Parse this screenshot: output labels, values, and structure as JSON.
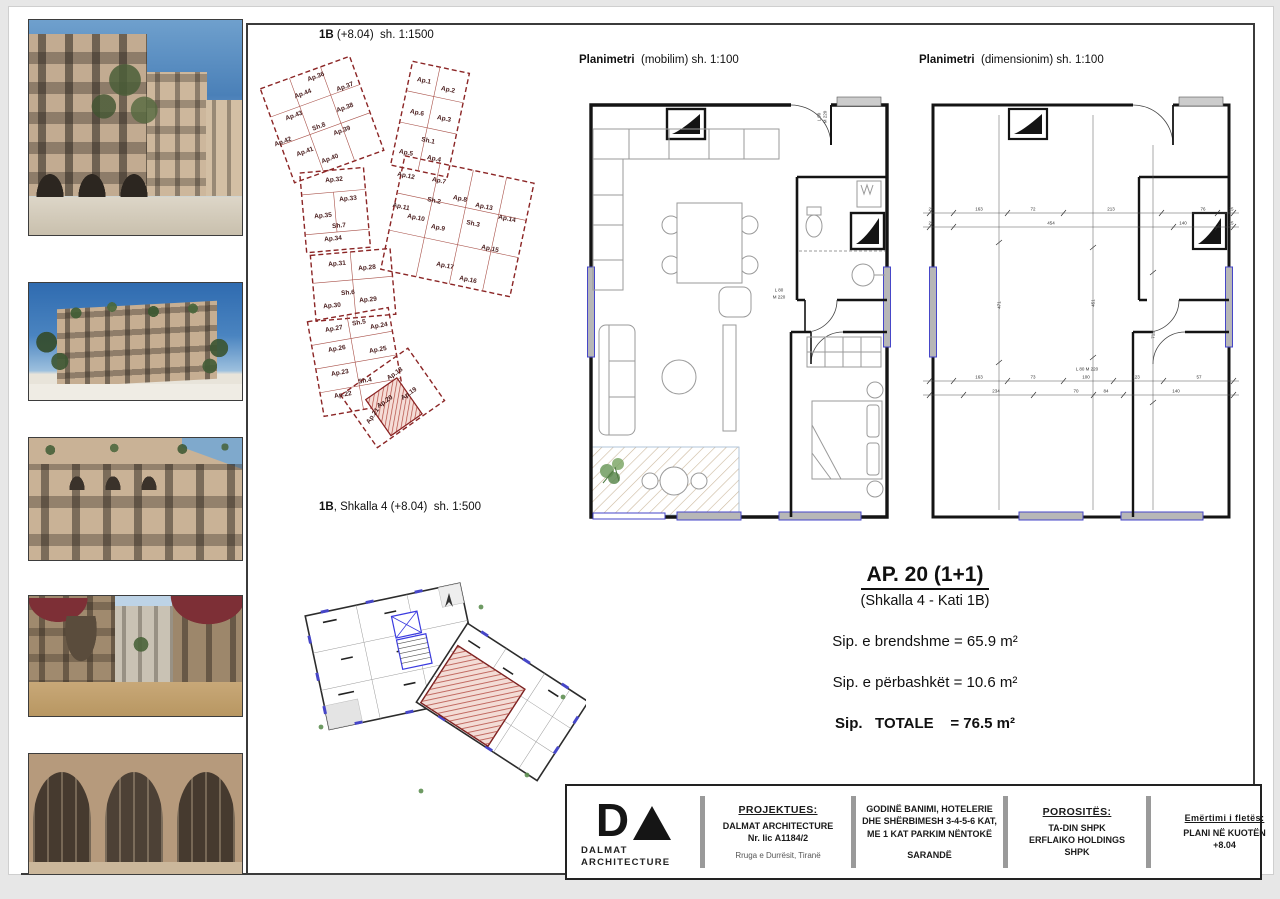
{
  "colors": {
    "accent_red": "#8b2525",
    "accent_blue": "#4646c8",
    "hatch_red": "#b2483f"
  },
  "site_plan": {
    "title": {
      "bold": "1B",
      "rest": " (+8.04)  sh. 1:1500"
    },
    "units": [
      {
        "t": "Ap.36",
        "x": 65,
        "y": 21,
        "r": -20
      },
      {
        "t": "Ap.37",
        "x": 94,
        "y": 31,
        "r": -20
      },
      {
        "t": "Ap.44",
        "x": 52,
        "y": 38,
        "r": -20
      },
      {
        "t": "Ap.38",
        "x": 94,
        "y": 52,
        "r": -20
      },
      {
        "t": "Ap.43",
        "x": 43,
        "y": 60,
        "r": -20
      },
      {
        "t": "Sh.8",
        "x": 68,
        "y": 71,
        "r": -20
      },
      {
        "t": "Ap.39",
        "x": 91,
        "y": 75,
        "r": -20
      },
      {
        "t": "Ap.42",
        "x": 32,
        "y": 86,
        "r": -20
      },
      {
        "t": "Ap.41",
        "x": 54,
        "y": 96,
        "r": -20
      },
      {
        "t": "Ap.40",
        "x": 79,
        "y": 103,
        "r": -20
      },
      {
        "t": "Ap.1",
        "x": 173,
        "y": 25,
        "r": 12
      },
      {
        "t": "Ap.2",
        "x": 197,
        "y": 34,
        "r": 12
      },
      {
        "t": "Ap.6",
        "x": 166,
        "y": 57,
        "r": 12
      },
      {
        "t": "Ap.3",
        "x": 193,
        "y": 63,
        "r": 12
      },
      {
        "t": "Sh.1",
        "x": 177,
        "y": 85,
        "r": 12
      },
      {
        "t": "Ap.5",
        "x": 155,
        "y": 97,
        "r": 12
      },
      {
        "t": "Ap.4",
        "x": 183,
        "y": 103,
        "r": 12
      },
      {
        "t": "Ap.12",
        "x": 155,
        "y": 120,
        "r": 12
      },
      {
        "t": "Ap.7",
        "x": 188,
        "y": 125,
        "r": 12
      },
      {
        "t": "Ap.11",
        "x": 150,
        "y": 151,
        "r": 12
      },
      {
        "t": "Sh.2",
        "x": 183,
        "y": 145,
        "r": 12
      },
      {
        "t": "Ap.8",
        "x": 209,
        "y": 143,
        "r": 12
      },
      {
        "t": "Ap.13",
        "x": 233,
        "y": 151,
        "r": 12
      },
      {
        "t": "Ap.10",
        "x": 165,
        "y": 162,
        "r": 12
      },
      {
        "t": "Ap.9",
        "x": 187,
        "y": 172,
        "r": 12
      },
      {
        "t": "Sh.3",
        "x": 222,
        "y": 168,
        "r": 12
      },
      {
        "t": "Ap.14",
        "x": 256,
        "y": 163,
        "r": 12
      },
      {
        "t": "Ap.15",
        "x": 239,
        "y": 193,
        "r": 12
      },
      {
        "t": "Ap.17",
        "x": 194,
        "y": 210,
        "r": 12
      },
      {
        "t": "Ap.16",
        "x": 217,
        "y": 224,
        "r": 12
      },
      {
        "t": "Ap.32",
        "x": 83,
        "y": 124,
        "r": -5
      },
      {
        "t": "Ap.33",
        "x": 97,
        "y": 143,
        "r": -5
      },
      {
        "t": "Ap.35",
        "x": 72,
        "y": 160,
        "r": -5
      },
      {
        "t": "Sh.7",
        "x": 88,
        "y": 170,
        "r": -5
      },
      {
        "t": "Ap.34",
        "x": 82,
        "y": 183,
        "r": -5
      },
      {
        "t": "Ap.31",
        "x": 86,
        "y": 208,
        "r": -5
      },
      {
        "t": "Ap.28",
        "x": 116,
        "y": 212,
        "r": -5
      },
      {
        "t": "Sh.6",
        "x": 97,
        "y": 237,
        "r": -5
      },
      {
        "t": "Ap.29",
        "x": 117,
        "y": 244,
        "r": -5
      },
      {
        "t": "Ap.30",
        "x": 81,
        "y": 250,
        "r": -5
      },
      {
        "t": "Ap.27",
        "x": 83,
        "y": 273,
        "r": -10
      },
      {
        "t": "Sh.5",
        "x": 108,
        "y": 267,
        "r": -10
      },
      {
        "t": "Ap.24",
        "x": 128,
        "y": 270,
        "r": -10
      },
      {
        "t": "Ap.26",
        "x": 86,
        "y": 293,
        "r": -10
      },
      {
        "t": "Ap.25",
        "x": 127,
        "y": 294,
        "r": -10
      },
      {
        "t": "Ap.23",
        "x": 89,
        "y": 317,
        "r": -10
      },
      {
        "t": "Sh.4",
        "x": 114,
        "y": 325,
        "r": -10
      },
      {
        "t": "Ap.22",
        "x": 92,
        "y": 339,
        "r": -10
      },
      {
        "t": "Ap.18",
        "x": 144,
        "y": 318,
        "r": -35
      },
      {
        "t": "Ap.19",
        "x": 158,
        "y": 338,
        "r": -35
      },
      {
        "t": "Ap.21",
        "x": 122,
        "y": 360,
        "r": -55
      },
      {
        "t": "Ap.20",
        "x": 134,
        "y": 346,
        "r": -35,
        "hl": true
      }
    ]
  },
  "plan500": {
    "title": {
      "bold": "1B",
      "rest": ", Shkalla 4 (+8.04)  sh. 1:500"
    }
  },
  "mobilim": {
    "title": {
      "bold": "Planimetri",
      "rest": "  (mobilim) sh. 1:100"
    },
    "labels": [
      {
        "t": "L 80",
        "x": 200,
        "y": 205
      },
      {
        "t": "M 220",
        "x": 200,
        "y": 212
      },
      {
        "t": "L 90",
        "x": 240,
        "y": 32,
        "r": -90
      },
      {
        "t": "M 220",
        "x": 246,
        "y": 32,
        "r": -90
      }
    ]
  },
  "dim": {
    "title": {
      "bold": "Planimetri",
      "rest": "  (dimensionim) sh. 1:100"
    },
    "labels": [
      {
        "t": "25",
        "x": 10,
        "y": 124
      },
      {
        "t": "163",
        "x": 58,
        "y": 124
      },
      {
        "t": "72",
        "x": 112,
        "y": 124
      },
      {
        "t": "213",
        "x": 190,
        "y": 124
      },
      {
        "t": "76",
        "x": 282,
        "y": 124
      },
      {
        "t": "25",
        "x": 310,
        "y": 124
      },
      {
        "t": "25",
        "x": 10,
        "y": 138
      },
      {
        "t": "454",
        "x": 130,
        "y": 138
      },
      {
        "t": "140",
        "x": 262,
        "y": 138
      },
      {
        "t": "25",
        "x": 310,
        "y": 138
      },
      {
        "t": "163",
        "x": 58,
        "y": 292
      },
      {
        "t": "73",
        "x": 112,
        "y": 292
      },
      {
        "t": "100",
        "x": 165,
        "y": 292
      },
      {
        "t": "123",
        "x": 215,
        "y": 292
      },
      {
        "t": "57",
        "x": 278,
        "y": 292
      },
      {
        "t": "234",
        "x": 75,
        "y": 306
      },
      {
        "t": "70",
        "x": 155,
        "y": 306
      },
      {
        "t": "84",
        "x": 185,
        "y": 306
      },
      {
        "t": "140",
        "x": 255,
        "y": 306
      },
      {
        "t": "471",
        "x": 78,
        "y": 220,
        "r": -90
      },
      {
        "t": "451",
        "x": 172,
        "y": 218,
        "r": -90
      },
      {
        "t": "712",
        "x": 232,
        "y": 250,
        "r": -90
      },
      {
        "t": "L 80  M 220",
        "x": 166,
        "y": 284
      }
    ]
  },
  "summary": {
    "title": "AP. 20 (1+1)",
    "subtitle": "(Shkalla 4 - Kati 1B)",
    "lines": [
      {
        "text": "Sip. e brendshme = 65.9 m²"
      },
      {
        "text": "Sip. e përbashkët = 10.6 m²"
      },
      {
        "text": "Sip.   TOTALE    = 76.5 m²"
      }
    ]
  },
  "titleblock": {
    "logo": {
      "letter": "D",
      "brand_line1": "DALMAT",
      "brand_line2": "ARCHITECTURE"
    },
    "projektues": {
      "heading": "PROJEKTUES:",
      "name": "DALMAT ARCHITECTURE",
      "license": "Nr. lic A1184/2",
      "address": "Rruga e Durrësit, Tiranë"
    },
    "project": {
      "description": "GODINË BANIMI, HOTELERIE DHE SHËRBIMESH 3-4-5-6 KAT, ME 1 KAT PARKIM NËNTOKË",
      "city": "SARANDË"
    },
    "porosites": {
      "heading": "POROSITËS:",
      "client1": "TA-DIN SHPK",
      "client2": "ERFLAIKO HOLDINGS",
      "client3": "SHPK"
    },
    "sheet": {
      "heading": "Emërtimi i fletës:",
      "line1": "PLANI NË KUOTËN",
      "line2": "+8.04"
    }
  }
}
